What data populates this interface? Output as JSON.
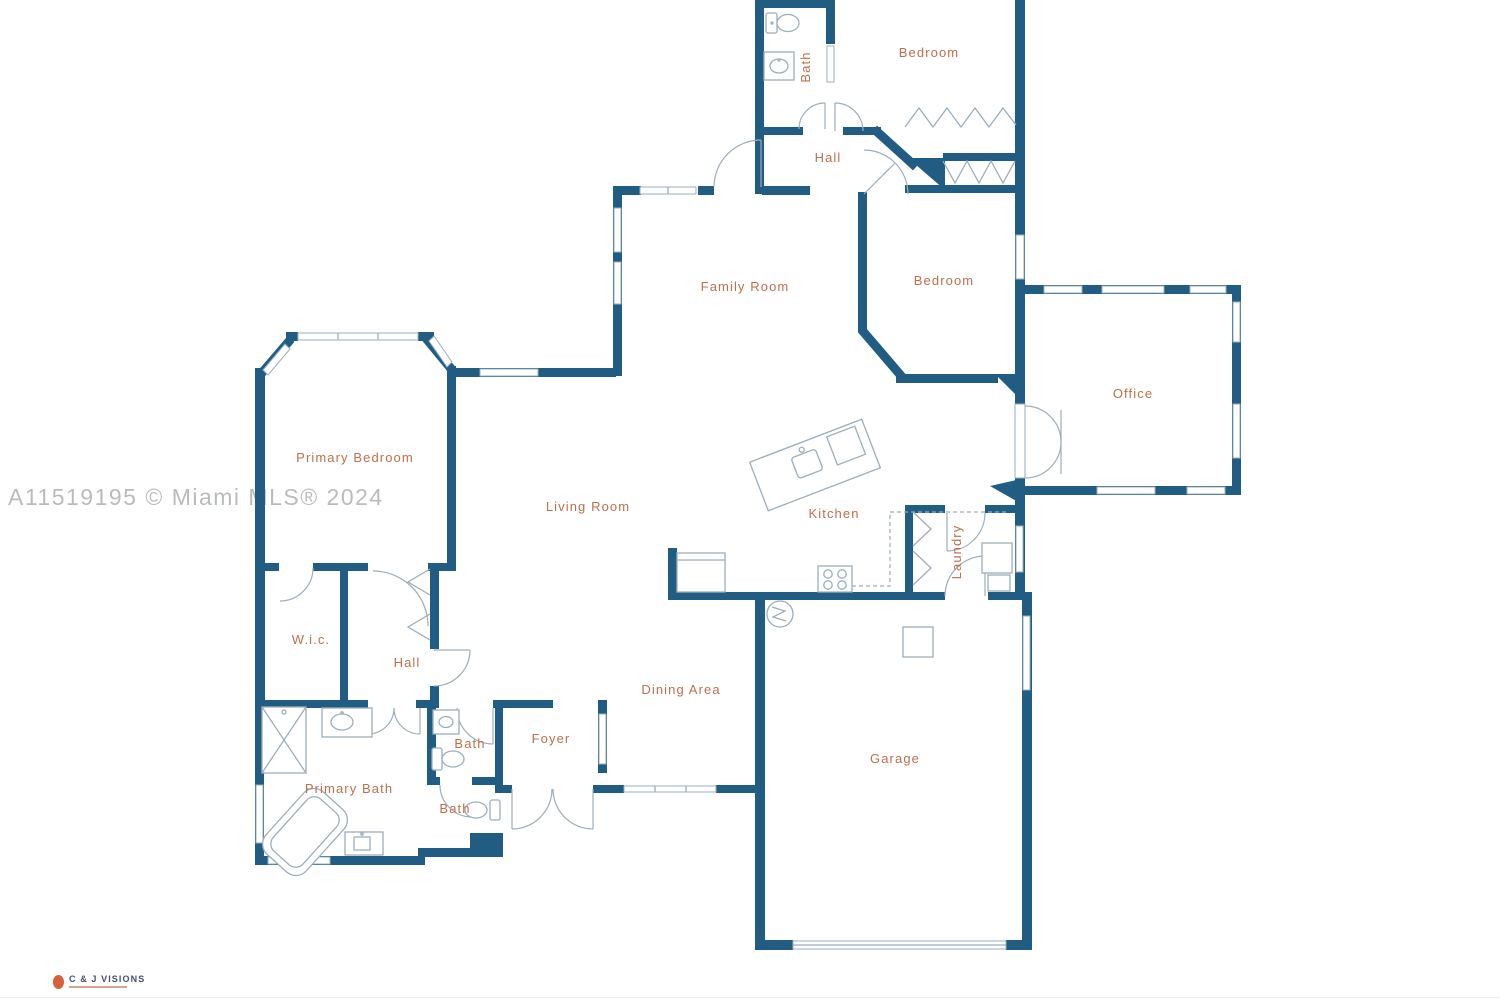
{
  "watermark": "A11519195 © Miami MLS® 2024",
  "branding": {
    "name": "C & J VISIONS"
  },
  "colors": {
    "wall": "#215d83",
    "room_label": "#bf6f4c",
    "watermark": "#b9bcbe",
    "fixture_line": "#9daebb",
    "logo_accent": "#d4603c"
  },
  "rooms": {
    "bath_top": "Bath",
    "bedroom_top": "Bedroom",
    "hall_top": "Hall",
    "family_room": "Family Room",
    "bedroom_mid": "Bedroom",
    "office": "Office",
    "primary_bedroom": "Primary Bedroom",
    "living_room": "Living Room",
    "kitchen": "Kitchen",
    "laundry": "Laundry",
    "wic": "W.i.c.",
    "hall_lower": "Hall",
    "dining_area": "Dining Area",
    "foyer": "Foyer",
    "bath_mid": "Bath",
    "bath_lower": "Bath",
    "primary_bath": "Primary Bath",
    "garage": "Garage"
  }
}
